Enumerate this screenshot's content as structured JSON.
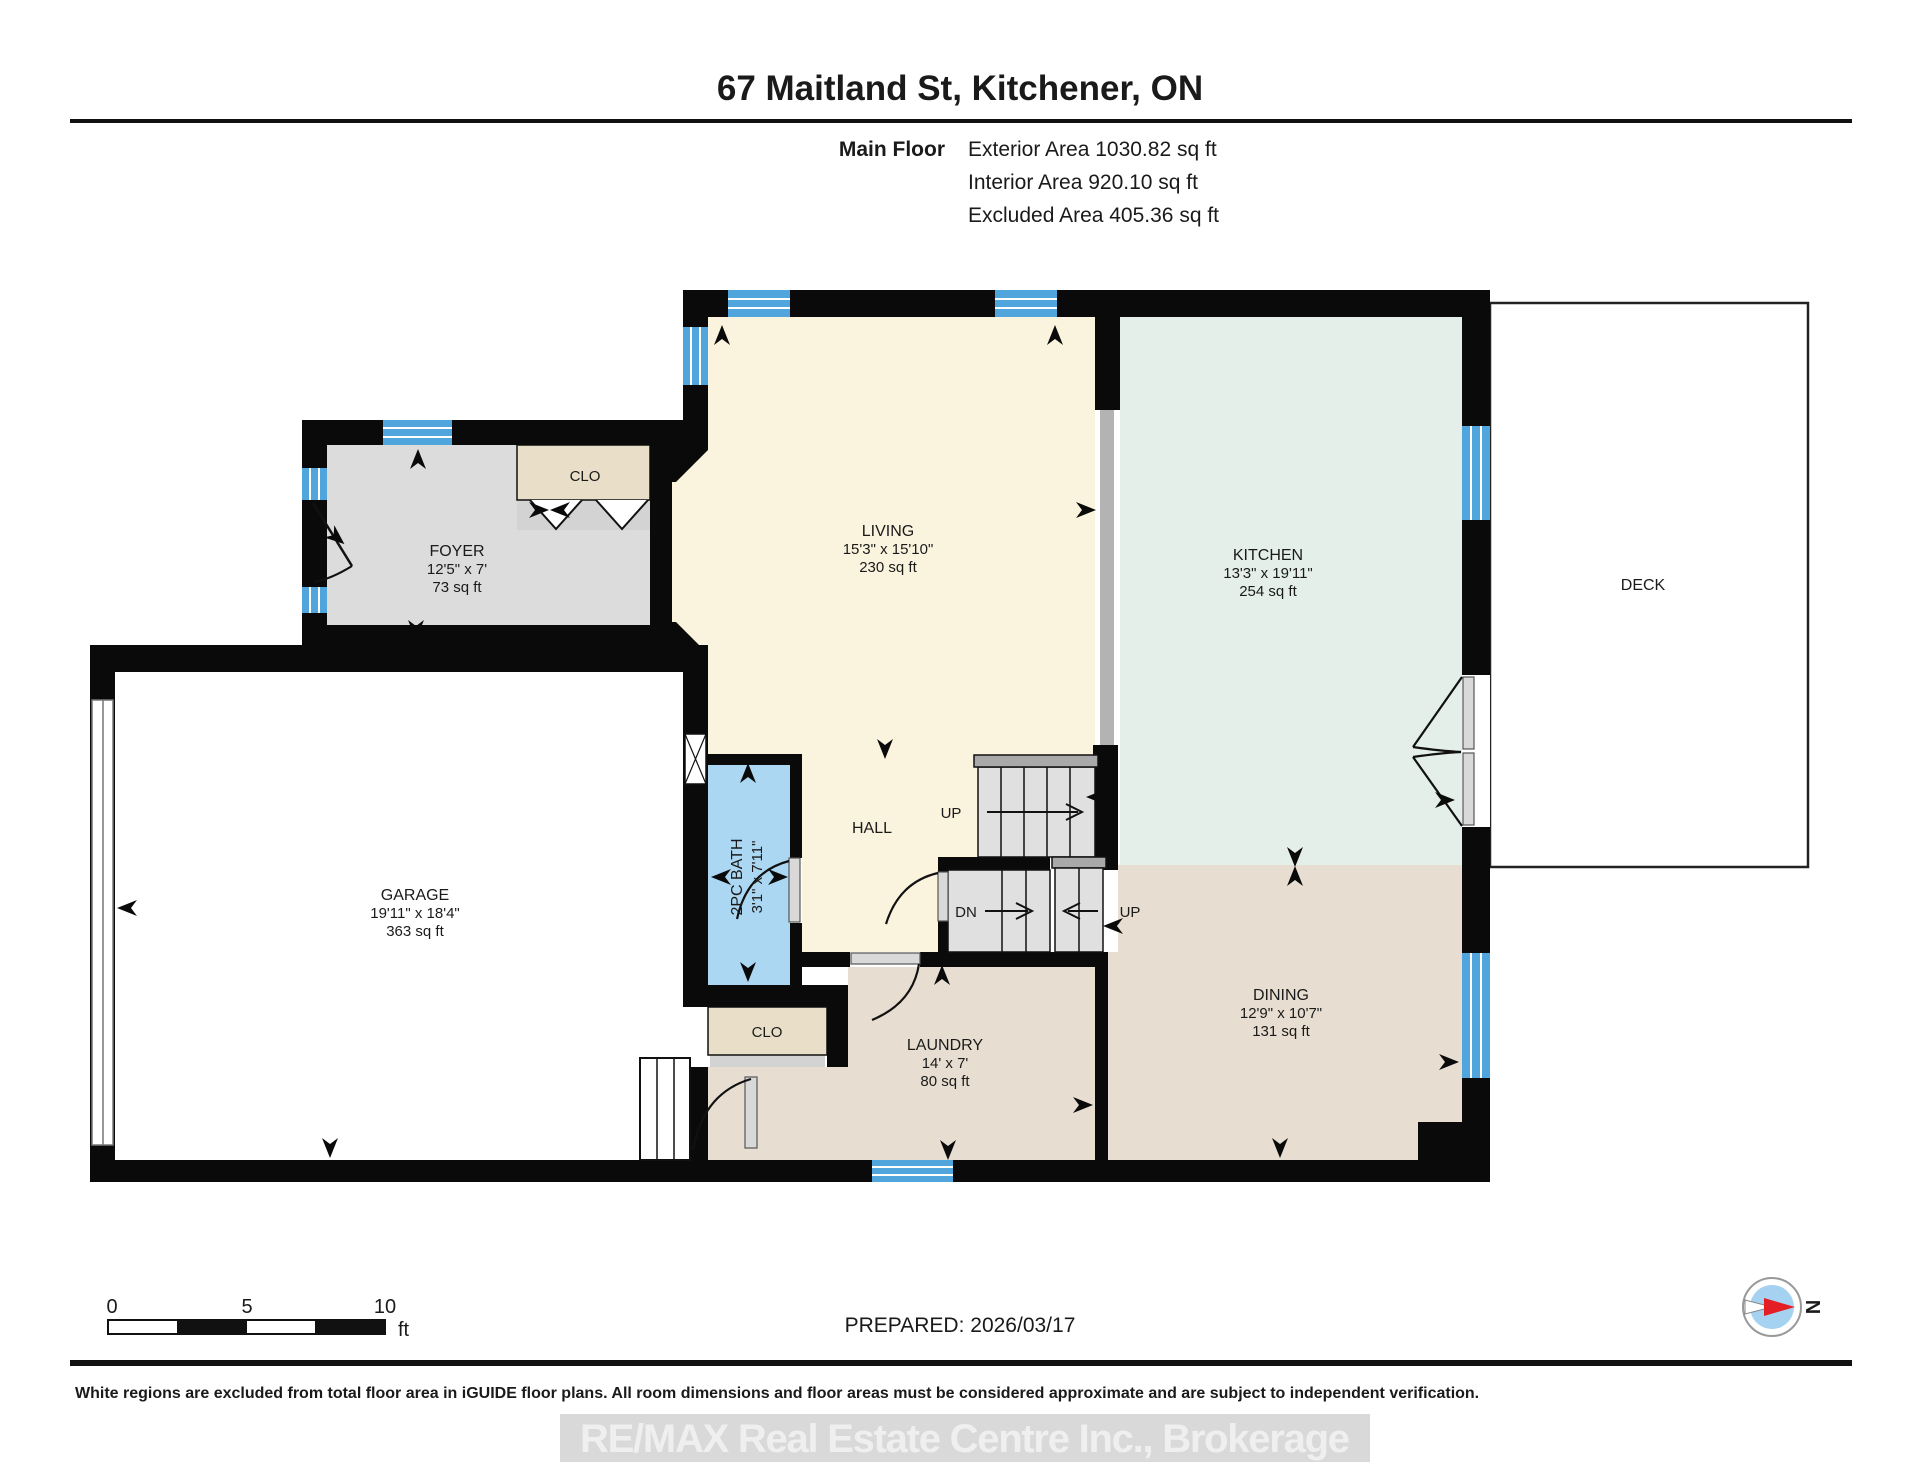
{
  "header": {
    "title": "67 Maitland St, Kitchener, ON",
    "floor_label": "Main Floor",
    "exterior_area": "Exterior Area 1030.82 sq ft",
    "interior_area": "Interior Area 920.10 sq ft",
    "excluded_area": "Excluded Area 405.36 sq ft"
  },
  "rooms": {
    "foyer": {
      "name": "FOYER",
      "dims": "12'5\" x 7'",
      "area": "73 sq ft"
    },
    "living": {
      "name": "LIVING",
      "dims": "15'3\" x 15'10\"",
      "area": "230 sq ft"
    },
    "kitchen": {
      "name": "KITCHEN",
      "dims": "13'3\" x 19'11\"",
      "area": "254 sq ft"
    },
    "garage": {
      "name": "GARAGE",
      "dims": "19'11\" x 18'4\"",
      "area": "363 sq ft"
    },
    "dining": {
      "name": "DINING",
      "dims": "12'9\" x 10'7\"",
      "area": "131 sq ft"
    },
    "laundry": {
      "name": "LAUNDRY",
      "dims": "14' x 7'",
      "area": "80 sq ft"
    },
    "bath": {
      "name": "2PC BATH",
      "dims": "3'1\" x 7'11\""
    },
    "hall": {
      "name": "HALL"
    },
    "deck": {
      "name": "DECK"
    },
    "closet_foyer": {
      "name": "CLO"
    },
    "closet_laundry": {
      "name": "CLO"
    }
  },
  "stairs": {
    "up_main": "UP",
    "down": "DN",
    "up_lower": "UP"
  },
  "footer": {
    "scale_0": "0",
    "scale_5": "5",
    "scale_10": "10",
    "scale_unit": "ft",
    "prepared": "PREPARED: 2026/03/17",
    "compass_north": "N",
    "disclaimer": "White regions are excluded from total floor area in iGUIDE floor plans. All room dimensions and floor areas must be considered approximate and are subject to independent verification.",
    "watermark": "RE/MAX Real Estate Centre Inc., Brokerage"
  },
  "colors": {
    "wall": "#0a0a0a",
    "window": "#50a5dc",
    "living": "#faf3de",
    "kitchen": "#e3efe8",
    "foyer": "#dcdcdc",
    "dining": "#e7ded1",
    "bath": "#abd7f3",
    "closet": "#e9dfc9",
    "stairs": "#e0e0e0",
    "stair_cap": "#a9a9a9",
    "compass_red": "#e31e24",
    "compass_blue": "#a5d2f0"
  }
}
